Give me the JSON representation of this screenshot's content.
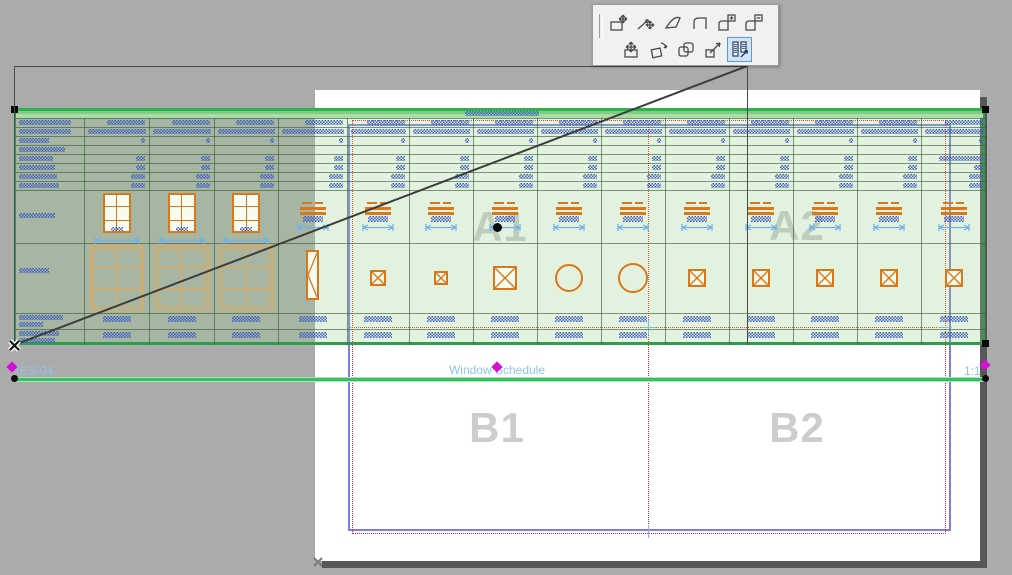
{
  "palette": {
    "row1_tools": [
      "move-node",
      "stretch-node",
      "mirror",
      "offset-edge",
      "add-to-polygon",
      "subtract-from-polygon"
    ],
    "row2_tools": [
      "drag",
      "rotate",
      "multiply",
      "resize",
      "drag-drawing"
    ],
    "selected_tool": "drag-drawing"
  },
  "layout_sheet": {
    "zone_labels": [
      "A1",
      "A2",
      "B1",
      "B2"
    ]
  },
  "drawing_title": {
    "id": "ES-04",
    "name": "Window Schedule",
    "scale": "1:1"
  },
  "schedule": {
    "title_greeked_width": 74,
    "header_col1_widths": [
      52,
      52,
      30,
      46,
      34,
      36,
      38,
      40
    ],
    "columns": [
      {
        "rowA": "text",
        "rowB": "text"
      },
      {
        "rowA": "window-elevation",
        "rowB": "window-elevation-large"
      },
      {
        "rowA": "window-elevation",
        "rowB": "window-elevation-large"
      },
      {
        "rowA": "window-elevation",
        "rowB": "window-elevation-large"
      },
      {
        "rowA": "sill-plan",
        "rowB": "window-narrow"
      },
      {
        "rowA": "sill-plan",
        "rowB": "square",
        "size": 16
      },
      {
        "rowA": "sill-plan",
        "rowB": "square",
        "size": 14
      },
      {
        "rowA": "sill-plan",
        "rowB": "square",
        "size": 24
      },
      {
        "rowA": "sill-plan",
        "rowB": "circle",
        "size": 28
      },
      {
        "rowA": "sill-plan",
        "rowB": "circle",
        "size": 30
      },
      {
        "rowA": "sill-plan",
        "rowB": "square",
        "size": 18
      },
      {
        "rowA": "sill-plan",
        "rowB": "square",
        "size": 18
      },
      {
        "rowA": "sill-plan",
        "rowB": "square",
        "size": 18
      },
      {
        "rowA": "sill-plan",
        "rowB": "square",
        "size": 18
      },
      {
        "rowA": "sill-plan",
        "rowB": "square",
        "size": 18
      }
    ]
  },
  "colors": {
    "workspace": "#ababab",
    "paper": "#ffffff",
    "drawing_tint": "rgba(157,210,143,0.29)",
    "frame_green": "#2ba04a",
    "title_line_green": "#3dbd62",
    "greeked_blue": "#3b5cc4",
    "symbol_orange": "#d9781a",
    "symbol_orange_light": "#eca64f",
    "dimension_blue": "#6eb2ee",
    "master_border_blue": "#7d7ddd",
    "margin_red": "#e02020",
    "hotspot_magenta": "#cf12cf",
    "zone_label_gray": "#cdcdcd",
    "selection_highlight": "#cfe4f8"
  }
}
